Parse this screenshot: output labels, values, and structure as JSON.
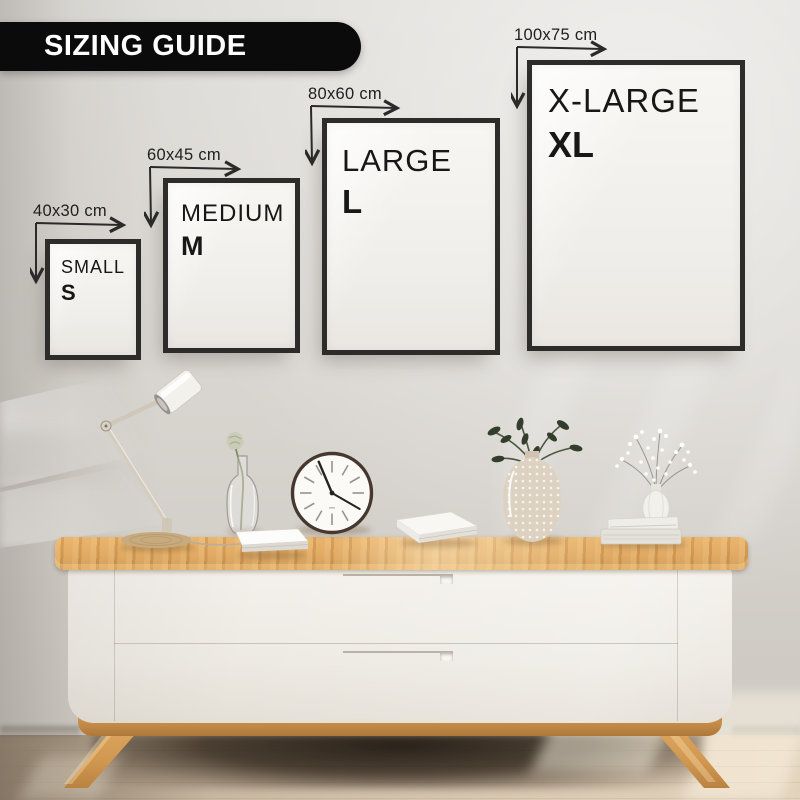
{
  "banner": {
    "label": "SIZING GUIDE",
    "background": "#0b0b0b",
    "text_color": "#ffffff"
  },
  "sizes": [
    {
      "id": "small",
      "dimension_label": "40x30 cm",
      "size_name": "SMALL",
      "size_letter": "S"
    },
    {
      "id": "medium",
      "dimension_label": "60x45 cm",
      "size_name": "MEDIUM",
      "size_letter": "M"
    },
    {
      "id": "large",
      "dimension_label": "80x60 cm",
      "size_name": "LARGE",
      "size_letter": "L"
    },
    {
      "id": "xlarge",
      "dimension_label": "100x75 cm",
      "size_name": "X-LARGE",
      "size_letter": "XL"
    }
  ],
  "scene": {
    "items": [
      "desk-lamp",
      "bud-vase-with-flower",
      "wall-clock",
      "white-notebook",
      "white-book",
      "bubble-glass-vase-with-plant",
      "white-vase-with-flowers-on-books",
      "wooden-sideboard"
    ]
  },
  "colors": {
    "wall": "#d8d5d0",
    "frame_border": "#2e2c2a",
    "frame_mat": "#f5f3f0",
    "annotation": "#222222",
    "wood_top": "#daa159",
    "cabinet_body": "#efece6",
    "floor": "#d2c1ab",
    "plant_green": "#39452f"
  }
}
